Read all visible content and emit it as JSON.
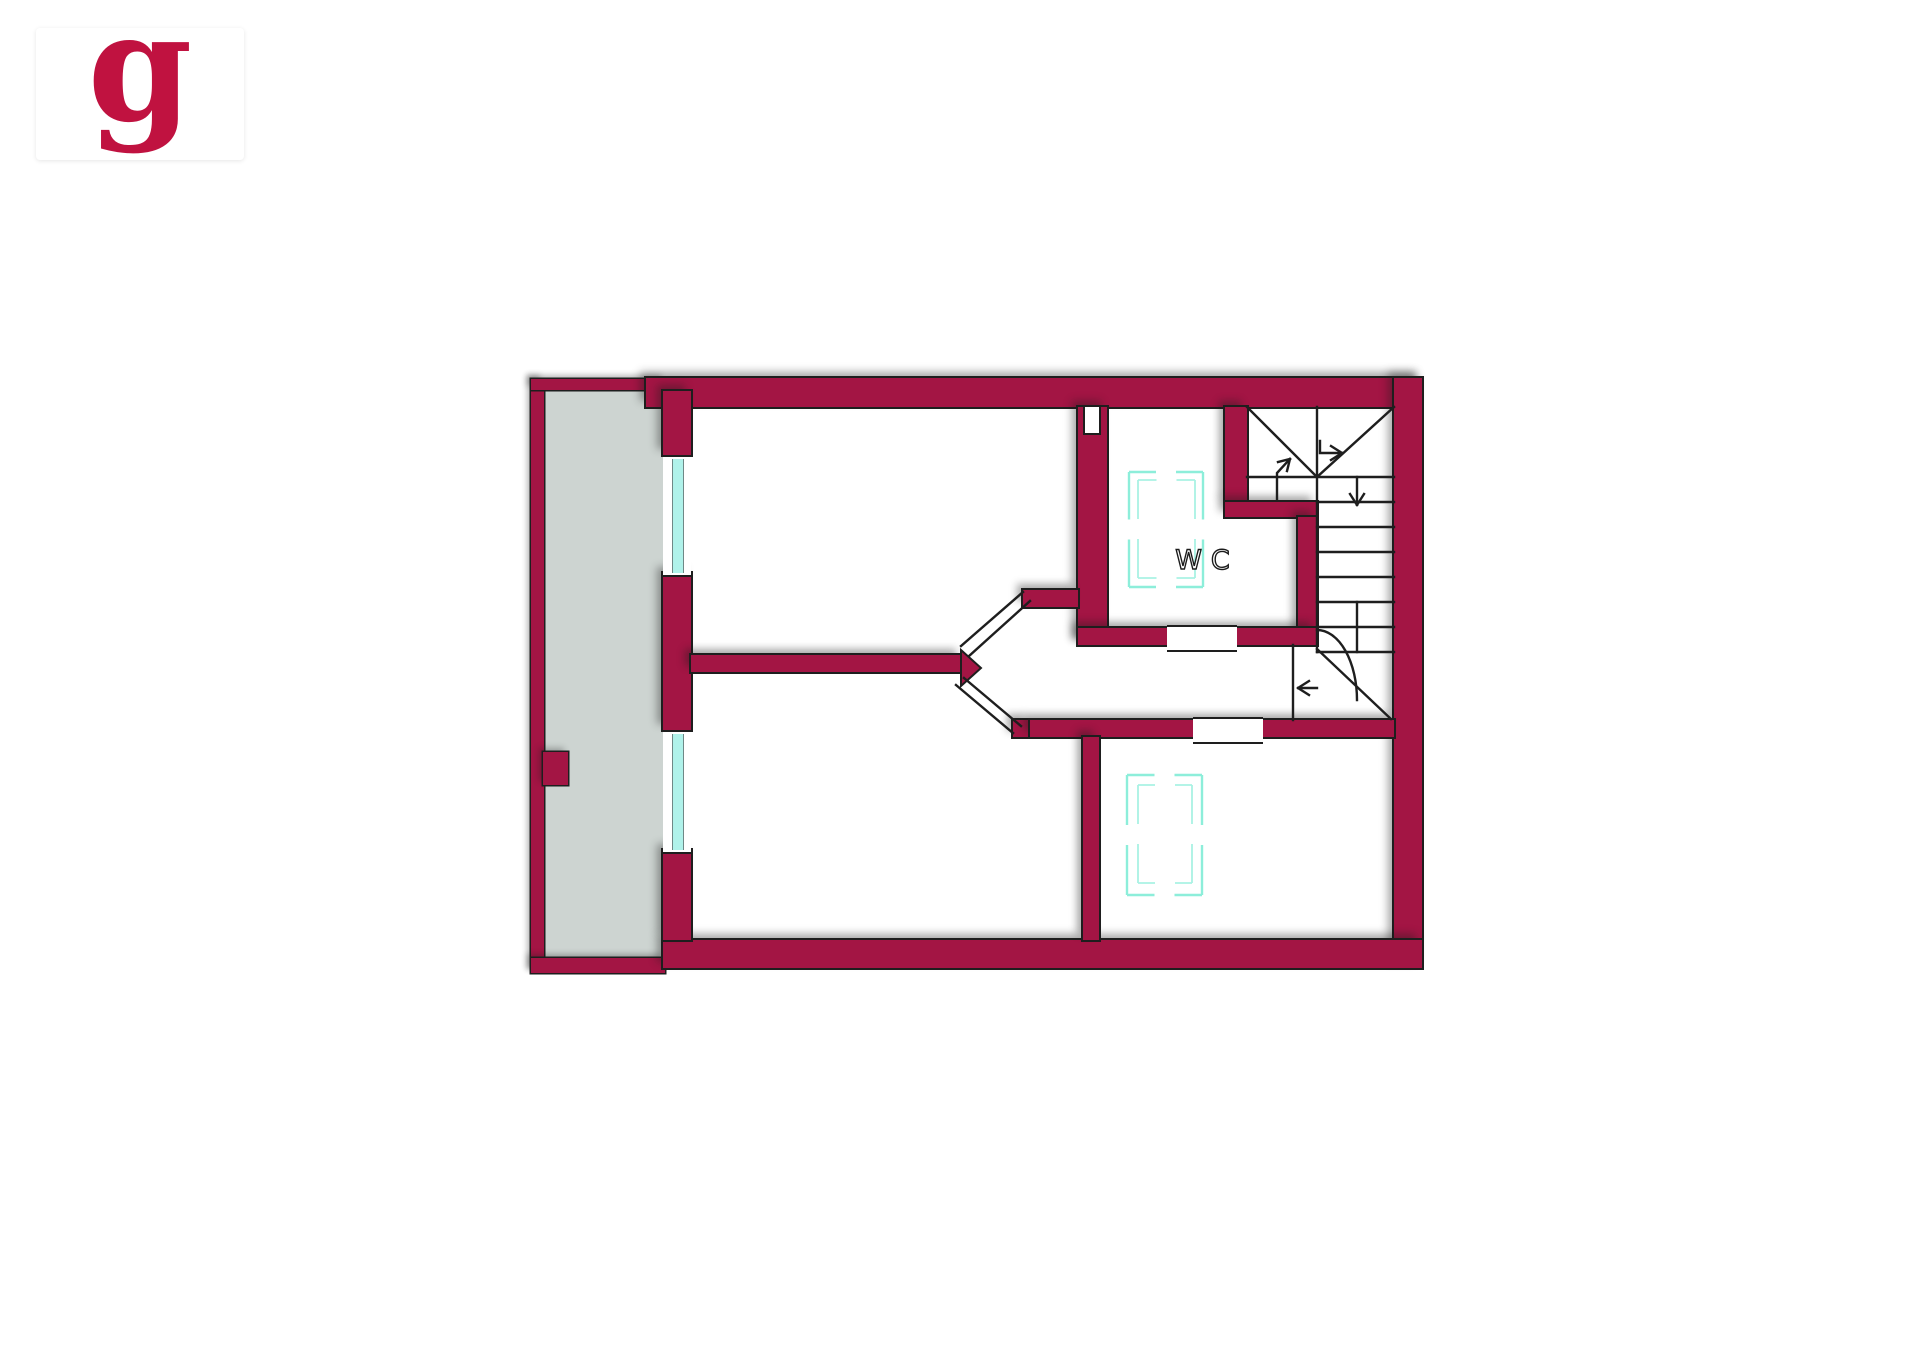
{
  "logo": {
    "letter": "g"
  },
  "plan": {
    "wc_label": "WC"
  },
  "colors": {
    "paper": "#ffffff",
    "wall": "#a31544",
    "logo": "#c01240",
    "balcony": "#cdd4d1",
    "glass": "#b0f2ea",
    "symbol": "#8deeda",
    "symbol_inner": "#a9f2e4",
    "line": "#1e1e1e"
  }
}
